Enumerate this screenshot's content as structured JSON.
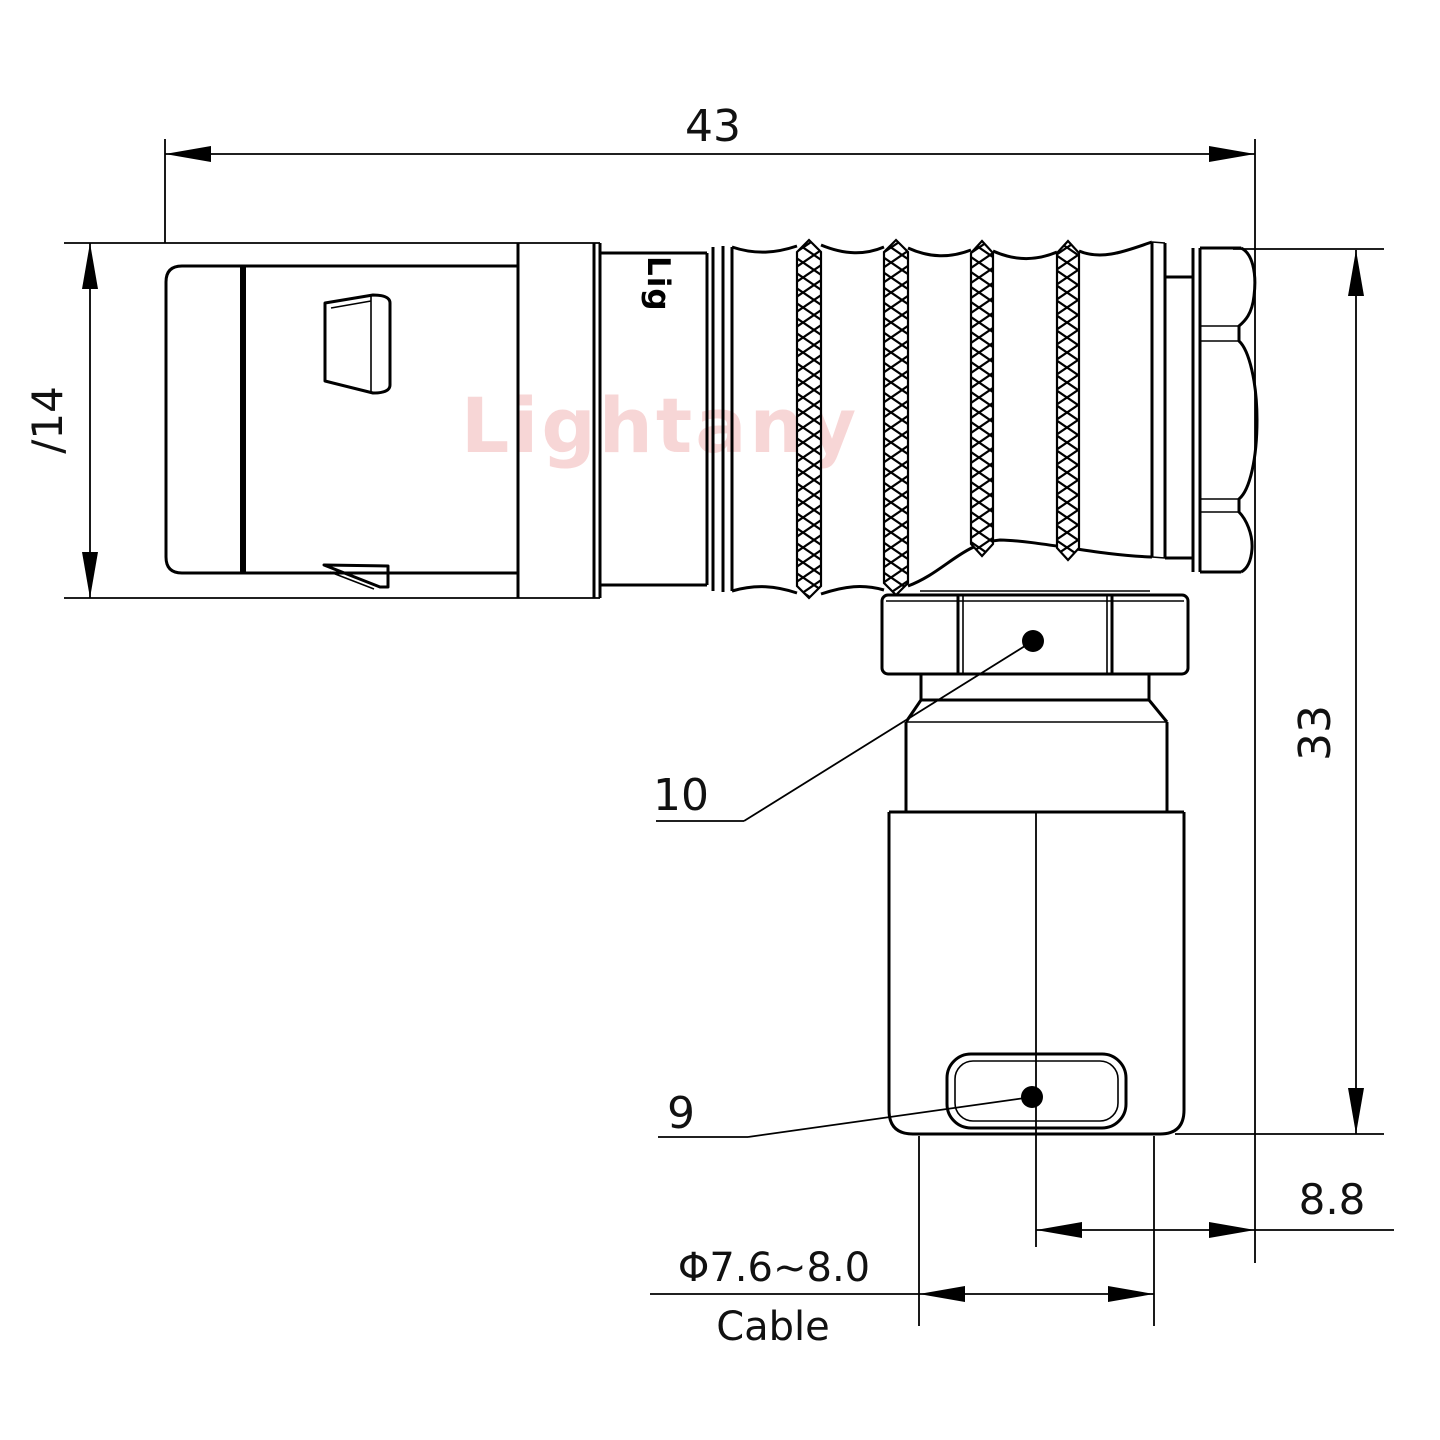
{
  "page": {
    "background": "#ffffff"
  },
  "drawing": {
    "stroke_color": "#000000",
    "text_color": "#111111",
    "watermark": {
      "text": "Lightany",
      "color": "#f3bdbd"
    },
    "brand_mark": {
      "text": "Lig"
    },
    "dimensions": {
      "overall_length": "43",
      "front_diameter": "∕14",
      "overall_height": "33",
      "rear_offset": "8.8",
      "cable_range": "Φ7.6~8.0",
      "cable_label": "Cable"
    },
    "part_labels": {
      "coupling_nut": "10",
      "cable_clamp": "9"
    }
  }
}
